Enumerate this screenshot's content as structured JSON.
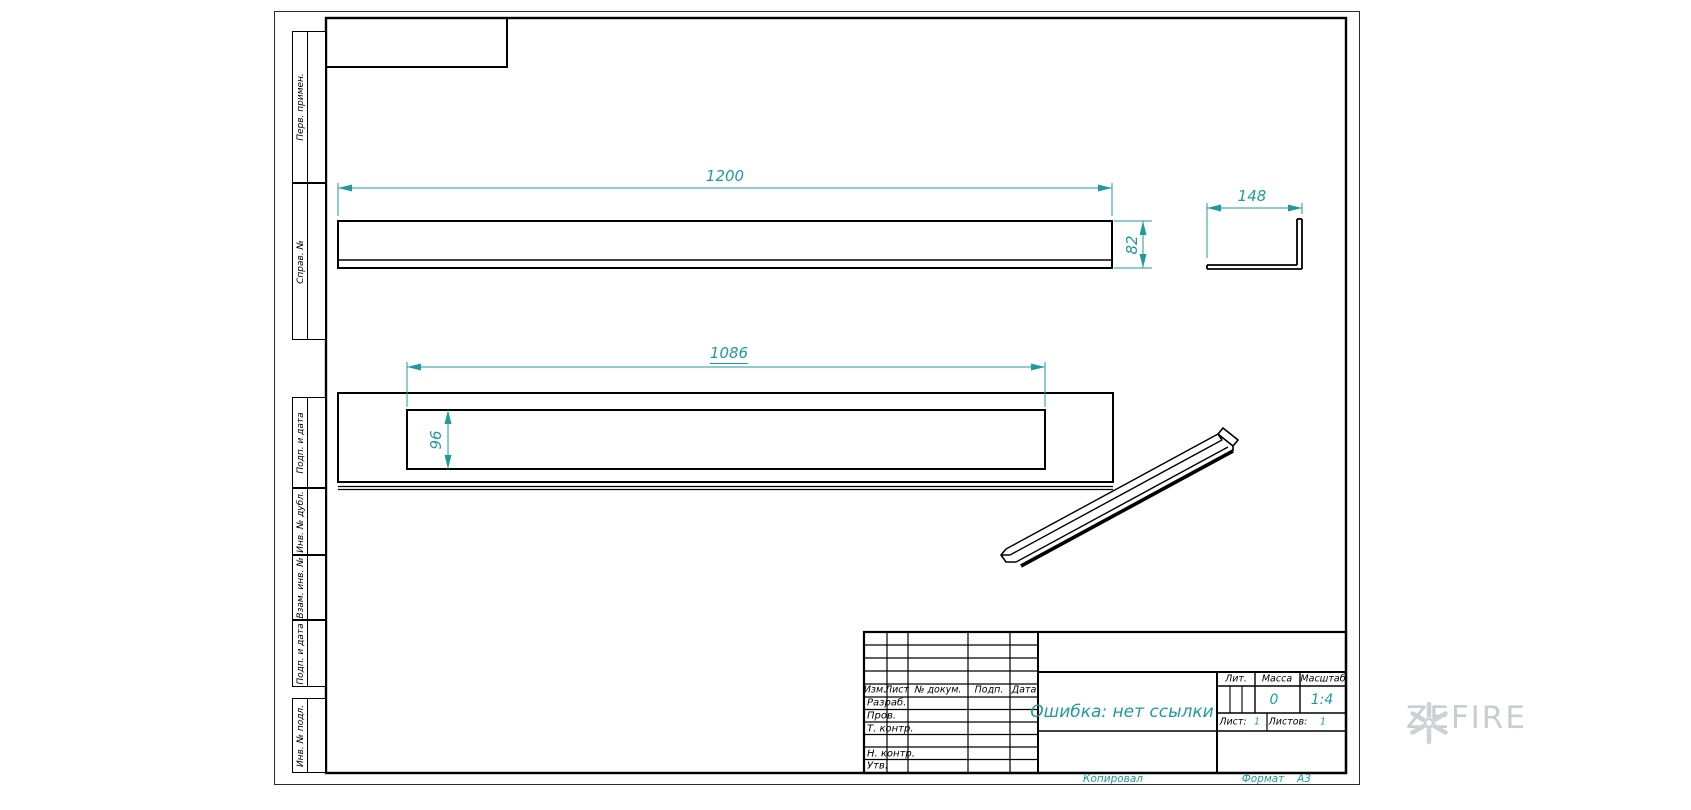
{
  "colors": {
    "accent": "#1f9a9d",
    "line": "#000000",
    "watermark_gray": "#c9ccd0"
  },
  "dimensions": {
    "overall_length": "1200",
    "side_height": "82",
    "side_width": "148",
    "cutout_length": "1086",
    "cutout_height": "96"
  },
  "margin_labels": [
    "Перв. примен.",
    "Справ. №",
    "Подп. и дата",
    "Инв. № дубл.",
    "Взам. инв. №",
    "Подп. и дата",
    "Инв. № подл."
  ],
  "title_block": {
    "header_columns": [
      "Изм.",
      "Лист",
      "№ докум.",
      "Подп.",
      "Дата"
    ],
    "row_labels": [
      "Разраб.",
      "Пров.",
      "Т. контр.",
      "Н. контр.",
      "Утв."
    ],
    "document_name": "Ошибка: нет ссылки",
    "lit_label": "Лит.",
    "mass_label": "Масса",
    "scale_label": "Масштаб",
    "mass_value": "0",
    "scale_value": "1:4",
    "sheet_label": "Лист:",
    "sheet_value": "1",
    "sheets_label": "Листов:",
    "sheets_value": "1"
  },
  "footer": {
    "copied_label": "Копировал",
    "format_label": "Формат",
    "format_value": "А3"
  },
  "watermark": {
    "brand": "ZEFIRE"
  }
}
